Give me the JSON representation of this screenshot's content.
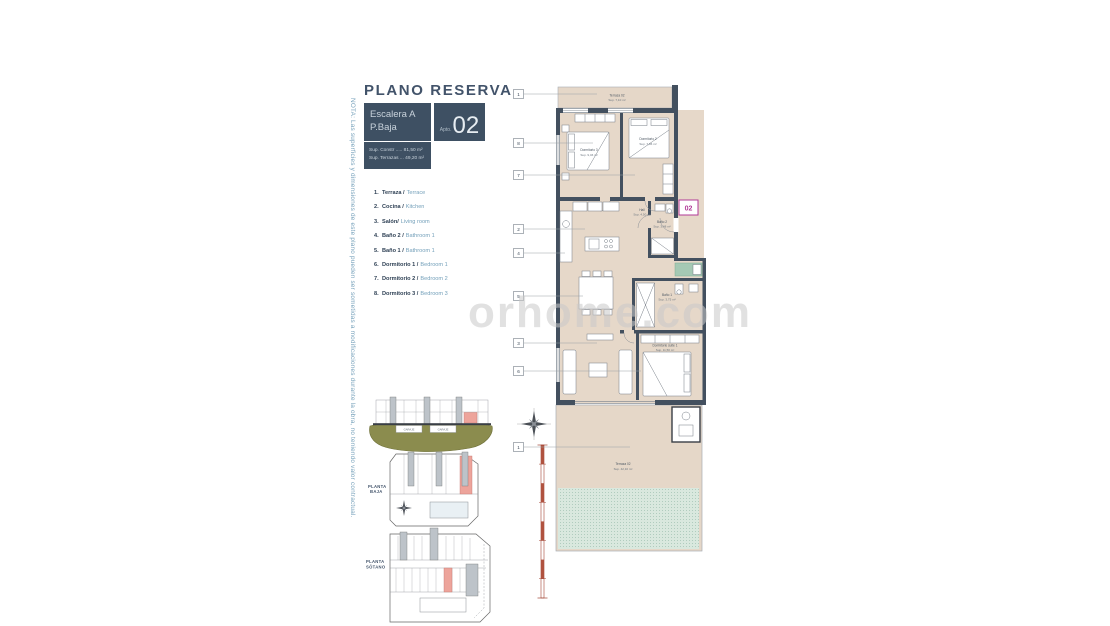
{
  "note": "NOTA: Las superficies y dimensiones de este plano pueden ser sometidas a modificaciones durante la obra, no teniendo valor contractual.",
  "header": {
    "title": "PLANO RESERVA",
    "stair_line1": "Escalera A",
    "stair_line2": "P.Baja",
    "apto_label": "Apto.",
    "apto_number": "02",
    "sup_constr": "Sup. Constr ..... 81,50 m²",
    "sup_terrazas": "Sup. Terrazas ... 49,20 m²"
  },
  "legend": {
    "items": [
      {
        "num": "1.",
        "es": "Terraza /",
        "en": "Terrace"
      },
      {
        "num": "2.",
        "es": "Cocina /",
        "en": "Kitchen"
      },
      {
        "num": "3.",
        "es": "Salón/",
        "en": "Living room"
      },
      {
        "num": "4.",
        "es": "Baño 2 /",
        "en": "Bathroom 1"
      },
      {
        "num": "5.",
        "es": "Baño 1 /",
        "en": "Bathroom 1"
      },
      {
        "num": "6.",
        "es": "Dormitorio 1 /",
        "en": "Bedroom 1"
      },
      {
        "num": "7.",
        "es": "Dormitorio 2 /",
        "en": "Bedroom 2"
      },
      {
        "num": "8.",
        "es": "Dormitorio 3 /",
        "en": "Bedroom 3"
      }
    ]
  },
  "plan": {
    "unit_badge": "02",
    "callouts": [
      "1",
      "8",
      "7",
      "2",
      "4",
      "5",
      "3",
      "6",
      "1"
    ],
    "rooms": {
      "terraza_top": {
        "name": "Terraza 02",
        "area": "Sup. 7,10 m²"
      },
      "dormitorio3": {
        "name": "Dormitorio 3",
        "area": "Sup. 9,46 m²"
      },
      "dormitorio2": {
        "name": "Dormitorio 2",
        "area": "Sup. 7,96 m²"
      },
      "hall": {
        "name": "Hall",
        "area": "Sup. 4,50 m²"
      },
      "bano2": {
        "name": "Baño 2",
        "area": "Sup. 3,48 m²"
      },
      "bano1": {
        "name": "Baño 1",
        "area": "Sup. 3,75 m²"
      },
      "suite": {
        "name": "Dormitorio suite 1",
        "area": "Sup. 11,50 m²"
      },
      "terraza_bottom": {
        "name": "Terraza 02",
        "area": "Sup. 42,10 m²"
      }
    }
  },
  "keyplans": {
    "garaje1": "GARAJE",
    "garaje2": "GARAJE",
    "planta_baja_line1": "PLANTA",
    "planta_baja_line2": "BAJA",
    "planta_sotano_line1": "PLANTA",
    "planta_sotano_line2": "SÓTANO"
  },
  "watermark": "orhome.com",
  "colors": {
    "slate": "#3E5063",
    "teal": "#74A0BA",
    "navy": "#2F4155",
    "magenta": "#B13A97",
    "wall": "#43505F",
    "floor": "#E6D8C9",
    "highlight": "#EDA49B",
    "olive": "#8B8C4E",
    "green_hatch": "#D9E8DE"
  }
}
